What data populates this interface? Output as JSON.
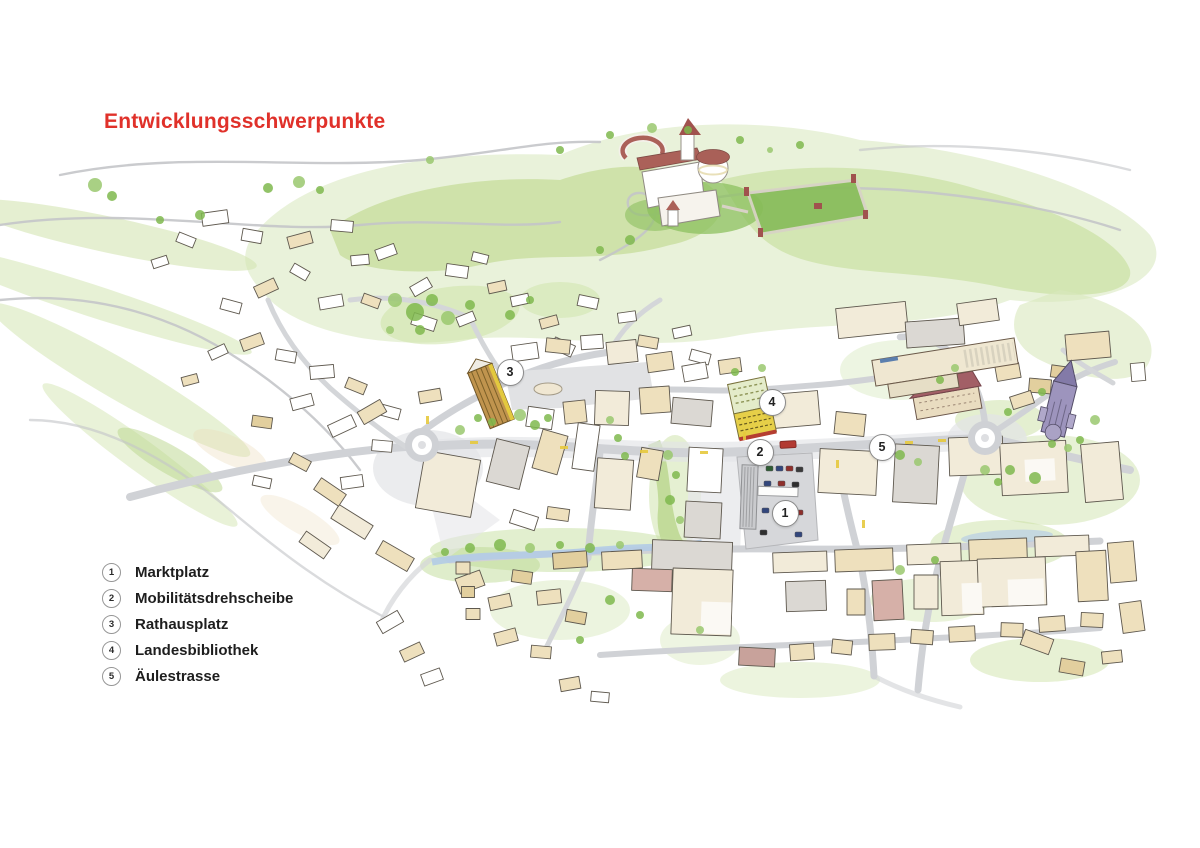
{
  "title": "Entwicklungsschwerpunkte",
  "colors": {
    "title_red": "#e0312a",
    "wash_green": "#c9e0a0",
    "road_gray": "#d0d2d6"
  },
  "legend": {
    "items": [
      {
        "num": "1",
        "label": "Marktplatz"
      },
      {
        "num": "2",
        "label": "Mobilitätsdrehscheibe"
      },
      {
        "num": "3",
        "label": "Rathausplatz"
      },
      {
        "num": "4",
        "label": "Landesbibliothek"
      },
      {
        "num": "5",
        "label": "Äulestrasse"
      }
    ]
  },
  "markers": [
    {
      "num": "1",
      "x": 784,
      "y": 512
    },
    {
      "num": "2",
      "x": 759,
      "y": 451
    },
    {
      "num": "3",
      "x": 509,
      "y": 371
    },
    {
      "num": "4",
      "x": 771,
      "y": 401
    },
    {
      "num": "5",
      "x": 881,
      "y": 446
    }
  ]
}
